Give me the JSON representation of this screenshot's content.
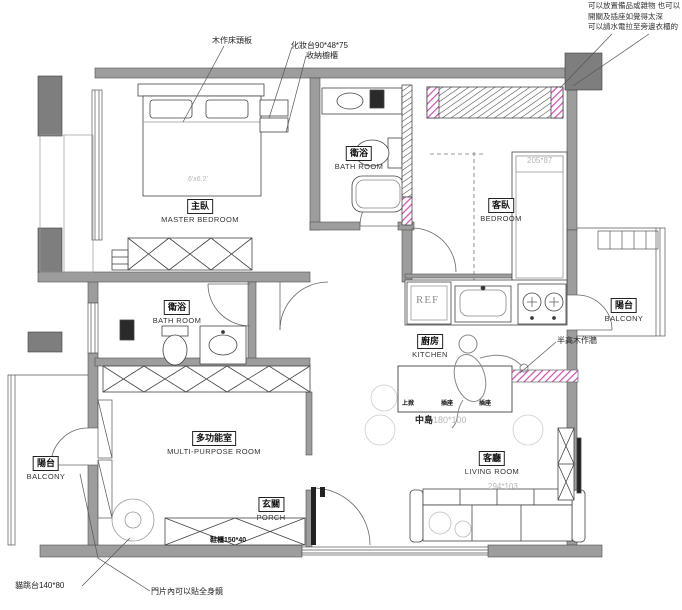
{
  "annotations": {
    "note_top_right_1": "可以放置備品或雜物 也可以",
    "note_top_right_2": "開關及插座如覺得太深",
    "note_top_right_3": "可以請水電拉至旁邊衣櫃的",
    "headboard": "木作床頭板",
    "vanity": "化妝台90*48*75",
    "storage_cabinet": "收納櫥櫃",
    "half_wall": "半高木作牆",
    "cat_platform": "貓跳台140*80",
    "mirror_note": "門片內可以貼全身鏡",
    "shoe_cabinet": "鞋櫃150*40"
  },
  "rooms": {
    "master_bedroom": {
      "zh": "主臥",
      "en": "MASTER BEDROOM",
      "bed_size": "6'x6.2'"
    },
    "bathroom_top": {
      "zh": "衛浴",
      "en": "BATH ROOM"
    },
    "bedroom2": {
      "zh": "客臥",
      "en": "BEDROOM",
      "dim": "205*87"
    },
    "bathroom_mid": {
      "zh": "衛浴",
      "en": "BATH ROOM"
    },
    "balcony_right": {
      "zh": "陽台",
      "en": "BALCONY"
    },
    "kitchen": {
      "zh": "廚房",
      "en": "KITCHEN"
    },
    "living_room": {
      "zh": "客廳",
      "en": "LIVING ROOM",
      "sofa_dim": "294*103"
    },
    "multi_purpose": {
      "zh": "多功能室",
      "en": "MULTI-PURPOSE ROOM"
    },
    "porch": {
      "zh": "玄關",
      "en": "PORCH"
    },
    "balcony_left": {
      "zh": "陽台",
      "en": "BALCONY"
    }
  },
  "island": {
    "zh": "中島",
    "dim": "180*100",
    "slots": [
      "上掀",
      "插座",
      "插座"
    ]
  },
  "fixtures": {
    "fridge": "REF"
  },
  "colors": {
    "wall": "#9d9d9d",
    "column": "#7e7e7e",
    "accent_pink": "#c94fb0",
    "dim_text": "#b5b5b5",
    "line": "#444444"
  }
}
